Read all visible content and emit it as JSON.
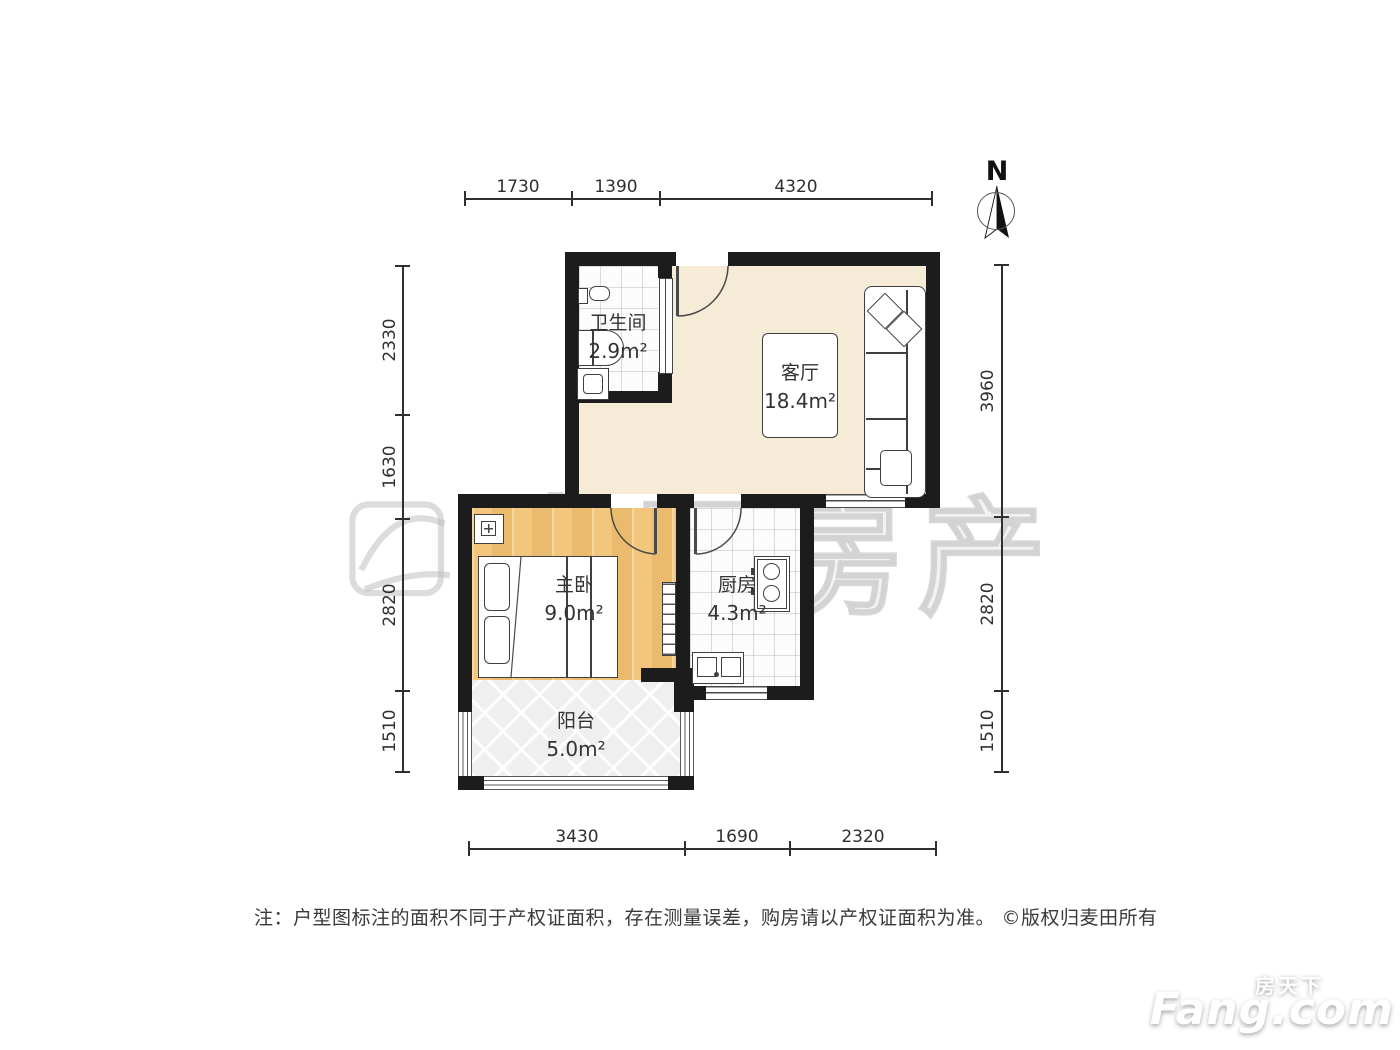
{
  "rooms": {
    "living": {
      "name": "客厅",
      "area": "18.4m²"
    },
    "bathroom": {
      "name": "卫生间",
      "area": "2.9m²"
    },
    "bedroom": {
      "name": "主卧",
      "area": "9.0m²"
    },
    "kitchen": {
      "name": "厨房",
      "area": "4.3m²"
    },
    "balcony": {
      "name": "阳台",
      "area": "5.0m²"
    }
  },
  "dims": {
    "top": [
      "1730",
      "1390",
      "4320"
    ],
    "left": [
      "2330",
      "1630",
      "2820",
      "1510"
    ],
    "right": [
      "3960",
      "2820",
      "1510"
    ],
    "bottom": [
      "3430",
      "1690",
      "2320"
    ]
  },
  "compass": {
    "label": "N"
  },
  "watermark": {
    "text": "麦田房产"
  },
  "footer": {
    "note": "注：户型图标注的面积不同于产权证面积，存在测量误差，购房请以产权证面积为准。 ©版权归麦田所有"
  },
  "brand": {
    "cn": "房天下",
    "en": "Fang.com"
  },
  "colors": {
    "wall": "#1c1c1c",
    "living_floor": "#f6ebd7",
    "bedroom_floor": "#f2c67c",
    "tile_floor": "#fcfcfc",
    "balcony_floor": "#efefef",
    "line": "#2f2f2f",
    "label": "#333333"
  }
}
